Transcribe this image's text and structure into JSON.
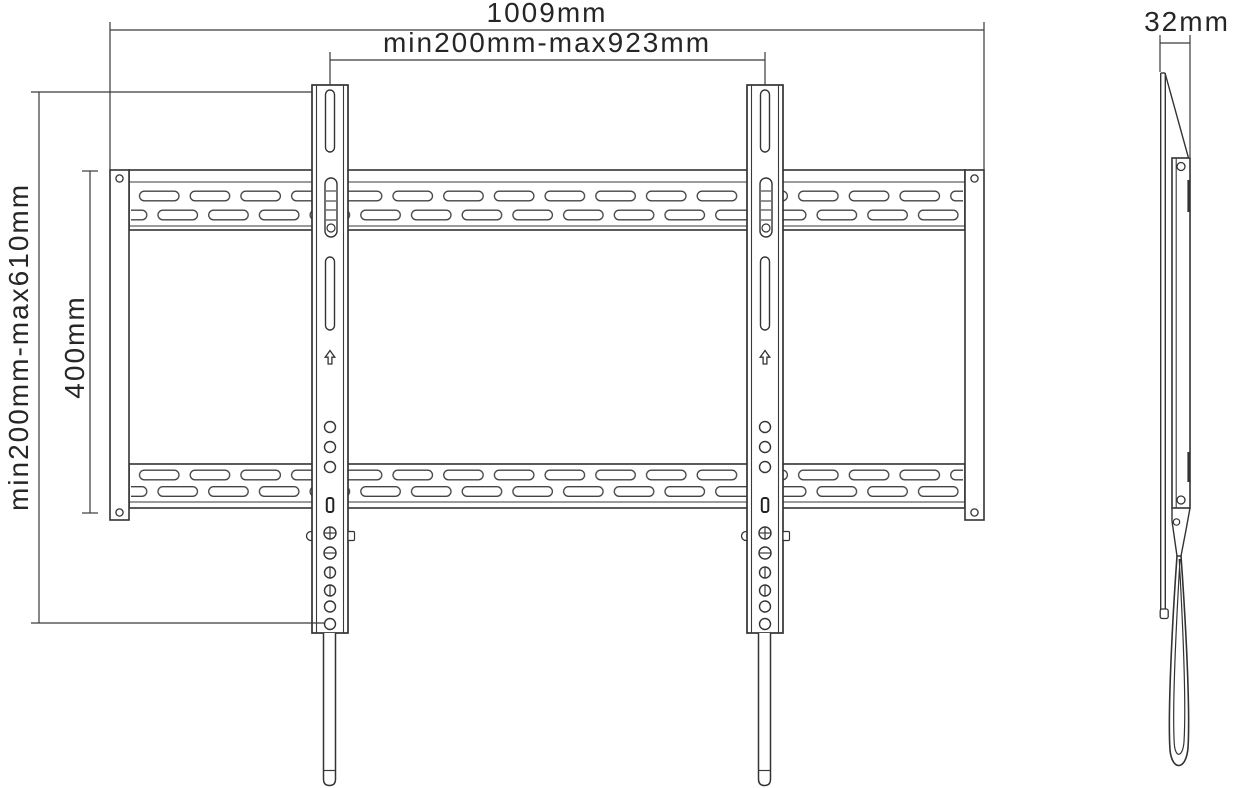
{
  "drawing": {
    "subject": "tv-wall-mount-technical-drawing",
    "colors": {
      "line": "#3a3a3a",
      "outline": "#333333",
      "text": "#262626",
      "background": "#ffffff"
    },
    "dimensions": {
      "overall_width": {
        "label": "1009mm"
      },
      "vesa_width_range": {
        "label": "min200mm-max923mm"
      },
      "vesa_height_range": {
        "label": "min200mm-max610mm"
      },
      "wall_plate_height": {
        "label": "400mm"
      },
      "profile_depth": {
        "label": "32mm"
      }
    }
  }
}
